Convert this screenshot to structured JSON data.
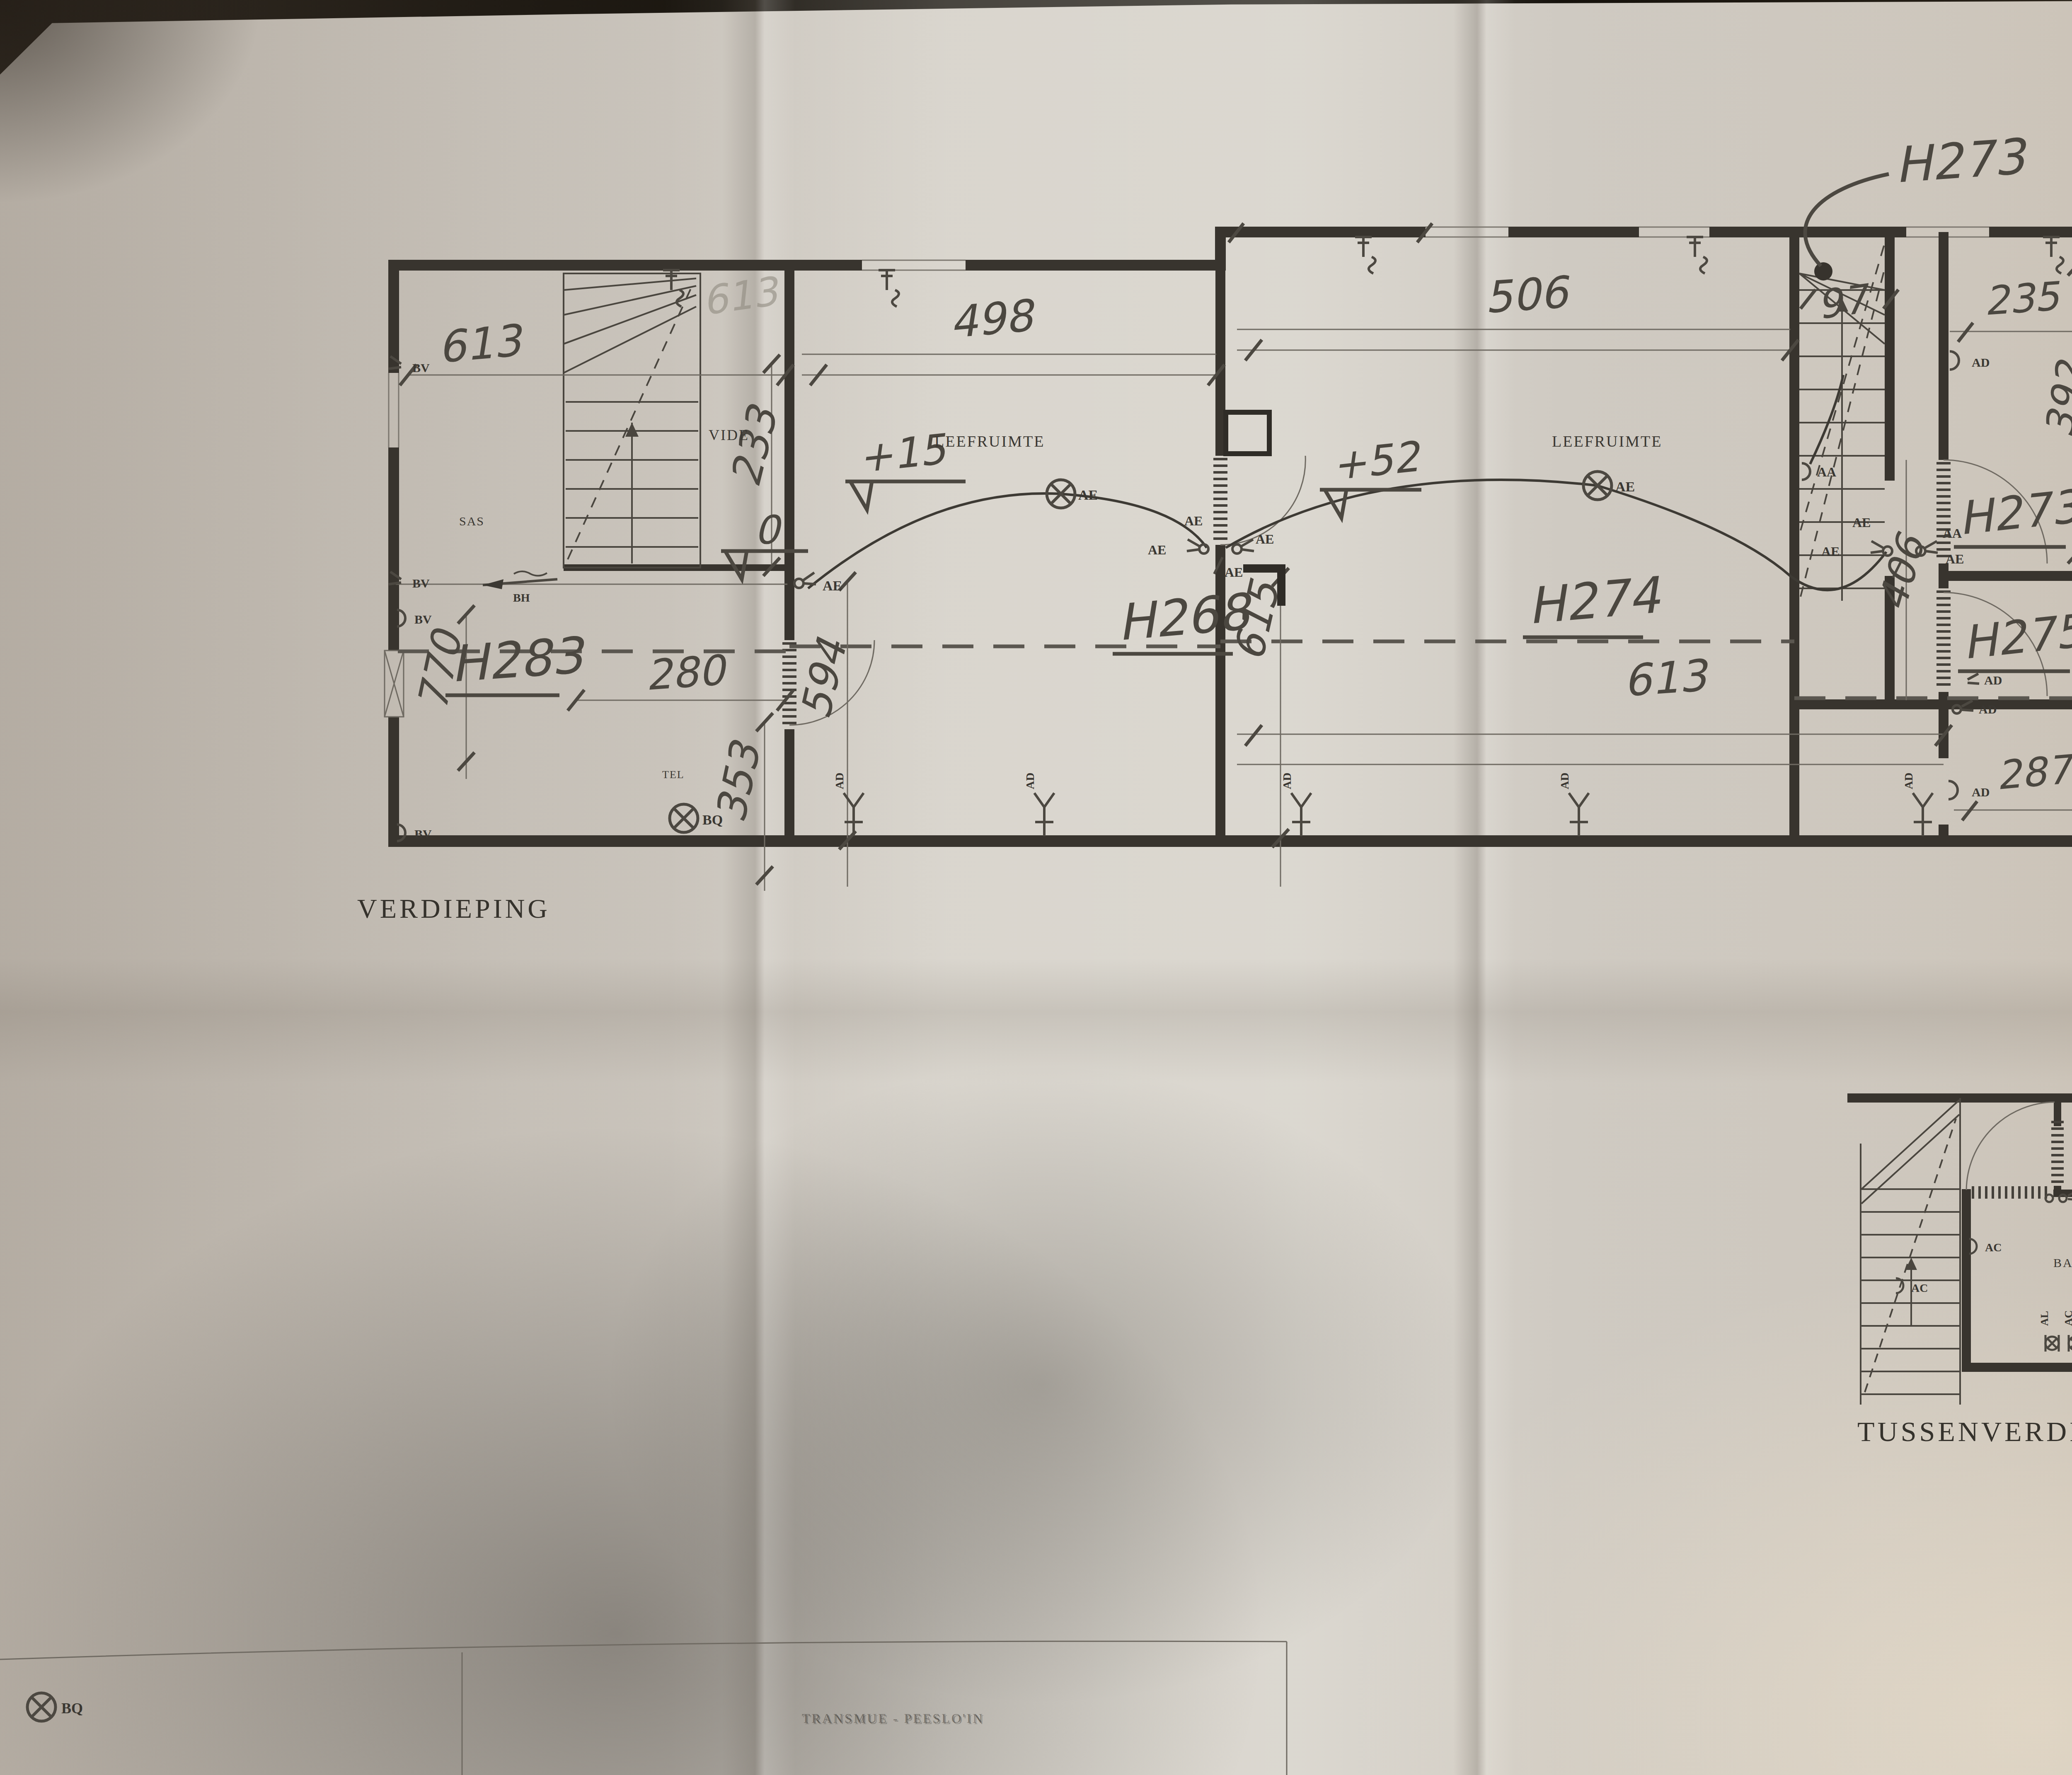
{
  "captions": {
    "floor": "VERDIEPING",
    "mezzanine": "TUSSENVERDIEPING"
  },
  "rooms": {
    "h283": "H283",
    "h268": "H268",
    "h274": "H274",
    "h273_room": "H273",
    "h275": "H275",
    "h273_annotation": "H273"
  },
  "room_names": {
    "vide": "VIDE",
    "leefruimte": "LEEFRUIMTE",
    "sas": "SAS",
    "tel": "TEL",
    "badkamer": "BADKAMER",
    "wc": "WC"
  },
  "dims": {
    "d613_top": "613",
    "d613_faint": "613",
    "d233": "233",
    "d280": "280",
    "d353": "353",
    "d770": "770",
    "d498": "498",
    "d594": "594",
    "d506": "506",
    "d615": "615",
    "d613_bottom": "613",
    "d97": "97",
    "d235": "235",
    "d392": "392",
    "d406_corridor": "406",
    "d406_right": "406",
    "d287": "287"
  },
  "levels": {
    "l0": "0",
    "l15": "+15",
    "l52": "+52"
  },
  "symbols": {
    "ae": "AE",
    "aa": "AA",
    "ad": "AD",
    "ac": "AC",
    "al": "AL",
    "bv": "BV",
    "bq": "BQ",
    "bh": "BH",
    "cb": "CB"
  },
  "stamp": {
    "text": "TRANSMUE - PEESLO'IN"
  }
}
